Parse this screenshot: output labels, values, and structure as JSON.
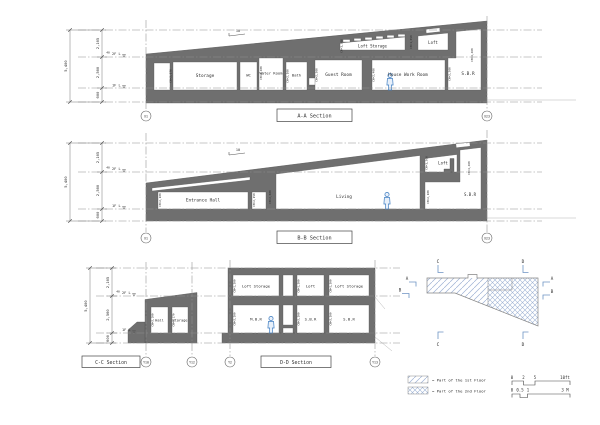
{
  "dims": {
    "total": "5,400",
    "seg_top": "2,165",
    "seg_mid": "2,560",
    "seg_base": "600",
    "offset": "40",
    "level2": "2F L",
    "level1": "1F L",
    "slope": "10"
  },
  "aa": {
    "title": "A-A Section",
    "grid_left": "X1",
    "grid_right": "X23",
    "rooms": {
      "storage": "Storage",
      "wc": "WC",
      "water_room": "Water Room",
      "bath": "Bath",
      "guest_room": "Guest Room",
      "house_work_room": "House Work Room",
      "sbr": "S.B.R",
      "loft_storage": "Loft Storage",
      "loft": "Loft"
    },
    "ch": {
      "storage": "CH=2,170",
      "water_room": "CH=2,400",
      "bath": "CH=2,100",
      "guest_room": "CH=2,300",
      "house_work_room": "CH=2,400",
      "sbr": "CH=2,300",
      "loft_storage": "CH=1,300",
      "loft": "CH=1,650",
      "right": "CH=4,460"
    }
  },
  "bb": {
    "title": "B-B Section",
    "grid_left": "X1",
    "grid_right": "X23",
    "rooms": {
      "entrance_hall": "Entrance Hall",
      "living": "Living",
      "loft": "Loft",
      "sbr": "S.B.R"
    },
    "ch": {
      "hall_left": "CH=2,100",
      "hall_right": "CH=2,150",
      "living": "CH=2,600",
      "loft": "CH=1,300",
      "sbr": "CH=2,100",
      "right": "CH=4,460"
    }
  },
  "cc": {
    "title": "C-C Section",
    "grid_left": "Y10",
    "grid_right": "Y12",
    "rooms": {
      "hall": "Hall",
      "storage": "Storage"
    },
    "ch": {
      "hall": "CH=2,100",
      "storage": "CH=2,170"
    }
  },
  "dd": {
    "title": "D-D Section",
    "grid_left": "Y2",
    "grid_right": "Y13",
    "rooms": {
      "loft_storage_left": "Loft Storage",
      "loft": "Loft",
      "loft_storage_right": "Loft Storage",
      "mbr": "M.B.R",
      "sbr_center": "S.B.R",
      "sbr_right": "S.B.R"
    },
    "ch": {
      "loft": "CH=1,300",
      "room": "CH=2,200"
    }
  },
  "keyplan": {
    "mark_a": "A",
    "mark_b": "B",
    "mark_c": "C",
    "mark_d": "D"
  },
  "legend": {
    "first_floor": "= Part of the 1st Floor",
    "second_floor": "= Part of the 2nd Floor"
  },
  "scale": {
    "ft": [
      "0",
      "2",
      "5",
      "10ft"
    ],
    "m": [
      "0",
      "0.5",
      "1",
      "3 M"
    ]
  }
}
